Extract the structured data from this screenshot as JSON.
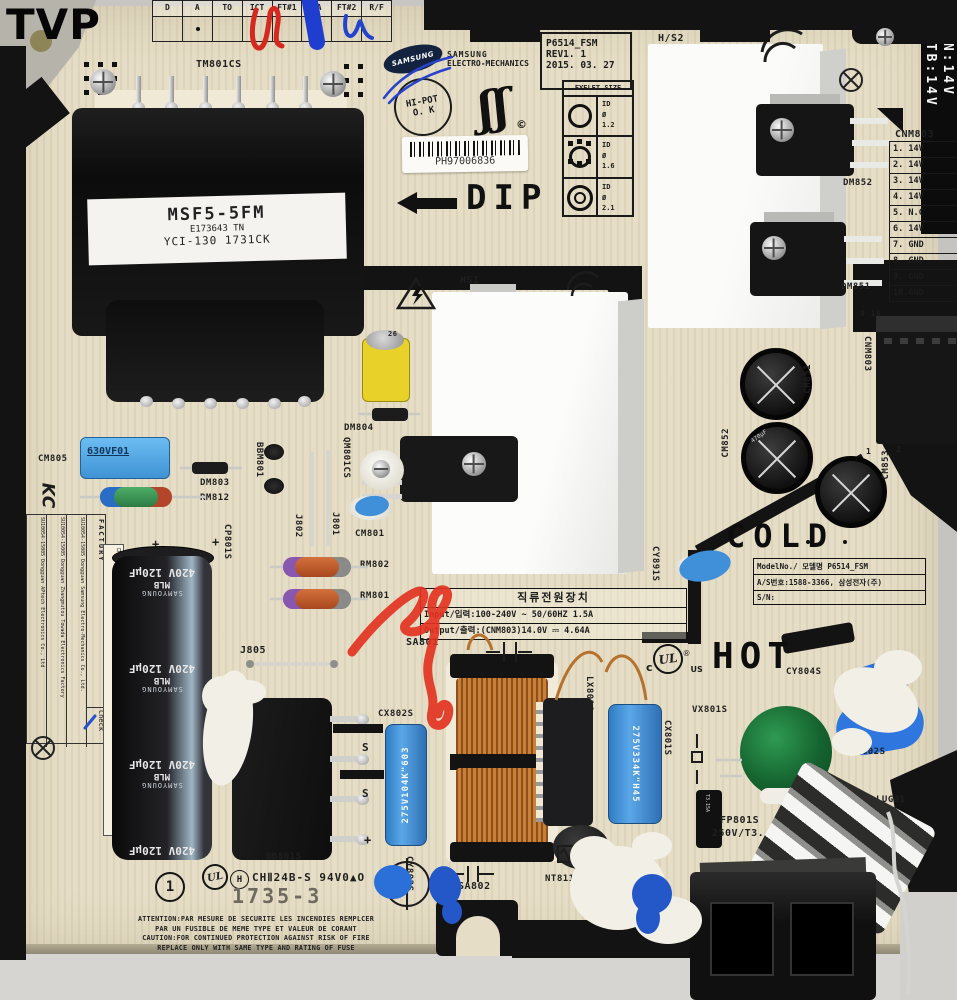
{
  "watermark": "TVP",
  "colors": {
    "board": "#e5ddc5",
    "frame_black": "#131313",
    "bg_gray": "#c8c6c2",
    "cap_blue": "#55aeeb",
    "film_blue": "#3f8fd6",
    "glue_blue": "#2458c8",
    "marker_red": "#e03322",
    "marker_blue": "#1f3ed0",
    "copper": "#b5722f",
    "varistor_green": "#1d7a3c",
    "resistor_orange": "#c2592b",
    "highlight_yellow": "#ffe23d"
  },
  "top_table": {
    "headers": [
      "D",
      "A",
      "TO",
      "ICT",
      "FT#1",
      "BA",
      "FT#2",
      "R/F"
    ]
  },
  "sk": {
    "tm801cs": "TM801CS",
    "cm805": "CM805",
    "dm803": "DM803",
    "rm812": "RM812",
    "bbm801": "BBM801",
    "dm804": "DM804",
    "qm801cs": "QM801CS",
    "j801": "J801",
    "j802": "J802",
    "cm801": "CM801",
    "cp801s": "CP801S",
    "rm802": "RM802",
    "rm801": "RM801",
    "hs1": "HS1",
    "hs2": "H/S2",
    "dm852": "DM852",
    "dm851": "DM851",
    "cnm_conn": "CNM803",
    "pins910": "9 10",
    "pin1": "1",
    "pin2": "2",
    "cm851": "CM851",
    "cm852": "CM852",
    "cm853": "CM853",
    "cy891s": "CY891S",
    "j805": "J805",
    "sa801": "SA801",
    "cx802s": "CX802S",
    "bd801s": "BD801S",
    "lx801s": "LX801S",
    "cx801s": "CX801S",
    "vx801s": "VX801S",
    "cy804s": "CY804S",
    "cy802s": "CY802S",
    "lug01": "LUG01",
    "fp801s": "FP801S",
    "fp_rating": "250V/T3. 15AL",
    "nt811s": "NT811S",
    "sa802": "SA802",
    "cy803s": "CY803S",
    "label26": "26",
    "plus": "+",
    "s_mark": "S",
    "cap470": "470µF",
    "cap630": "630VF01"
  },
  "transformer": {
    "line1": "MSF5-5FM",
    "line2": "E173643 TN",
    "line3": "YCI-130 1731CK"
  },
  "brand": {
    "oval": "SAMSUNG",
    "name": "SAMSUNG",
    "division": "ELECTRO-MECHANICS"
  },
  "stamps": {
    "hipot1": "HI-POT",
    "hipot2": "O. K",
    "swash": "ʃʃ",
    "copyright": "©"
  },
  "rev_box": {
    "model": "P6514_FSM",
    "rev": "REV1. 1",
    "date": "2015. 03. 27"
  },
  "eyelet": {
    "title": "EYELET SIZE",
    "rows": [
      {
        "l1": "ID",
        "l2": "Ø",
        "l3": "1.2"
      },
      {
        "l1": "ID",
        "l2": "Ø",
        "l3": "1.6"
      },
      {
        "l1": "ID",
        "l2": "Ø",
        "l3": "2.1"
      }
    ]
  },
  "barcode": {
    "number": "PH97006836"
  },
  "dip": {
    "label": "DIP"
  },
  "stb": {
    "line1": "STB:14V",
    "line2": "ON:14V"
  },
  "cnm": {
    "title": "CNM803",
    "pins": [
      "1. 14V",
      "2. 14V",
      "3. 14V",
      "4. 14V",
      "5. N.C",
      "6. 14V",
      "7. GND",
      "8. GND",
      "9. GND",
      "10.GND"
    ]
  },
  "zones": {
    "cold": "COLD",
    "hot": "HOT"
  },
  "model_table": {
    "row1": "ModelNo./ 모델명 P6514_FSM",
    "row2": "A/S번호:1588-3366, 삼성전자(주)",
    "row3": "S/N:"
  },
  "power_table": {
    "title": "직류전원장치",
    "input": "Input/입력:100-240V ~ 50/60HZ 1.5A",
    "output": "Output/출력:(CNM803)14.0V ⎓ 4.64A"
  },
  "ul": {
    "c": "c",
    "ul": "UL",
    "us": "US",
    "r": "®"
  },
  "cert": {
    "h": "H",
    "line": "CHⅡ24B-S 94V0▲O",
    "date": "1735-3",
    "one": "1",
    "n": "N"
  },
  "caution": {
    "l1": "ATTENTION:PAR MESURE DE SECURITE LES INCENDIES REMPLCER",
    "l2": "PAR UN FUSIBLE DE MEME TYPE  ET VALEUR DE CORANT",
    "l3": "CAUTION:FOR CONTINUED PROTECTION AGAINST RISK OF FIRE",
    "l4": "REPLACE ONLY WITH SAME TYPE AND RATING OF FUSE"
  },
  "factory": {
    "header": "FACTORY",
    "rows": [
      "SU10054-15005 Dongguan Samsung Electro-Mechanics Co., Ltd.",
      "SU10054-15005 Dongguan Zhangmutou Towada Electronics Factory",
      "SU10054-15005 Dongguan APtech Electronics Co., Ltd"
    ],
    "check": "Check"
  },
  "strip": {
    "model": "모델명:P6514_FSM",
    "madein": "Made in China",
    "cn": "中国义乌"
  },
  "bigcap": {
    "brand": "SAMYOUNG",
    "value": "420V 120µF",
    "series": "MLB"
  },
  "film": {
    "cx802s": "275V104K\"603",
    "cx801s": "275V334K\"H45"
  },
  "fuse_body": "T3.15A",
  "kc": "KC"
}
